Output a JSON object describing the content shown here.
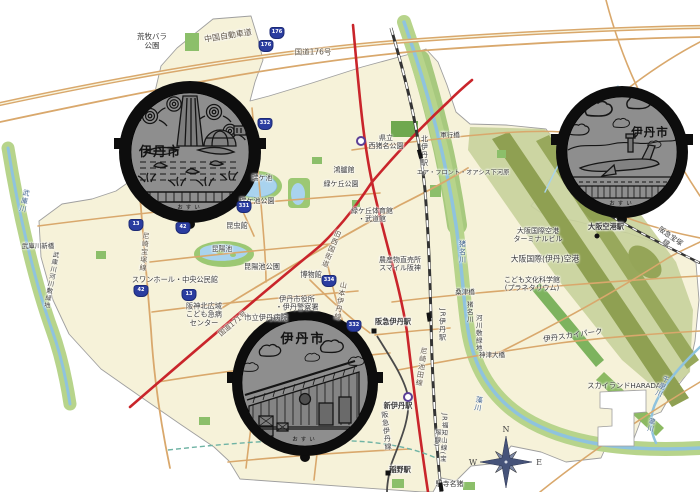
{
  "compass": {
    "n": "N",
    "w": "W",
    "e": "E",
    "s": "S"
  },
  "manholes": [
    {
      "design": "rose-pond-design",
      "city_label": "伊丹市",
      "bottom_label": "おすい"
    },
    {
      "design": "airport-design",
      "city_label": "伊丹市",
      "bottom_label": "おすい"
    },
    {
      "design": "brewery-design",
      "city_label": "伊丹市",
      "bottom_label": "おすい"
    }
  ],
  "route_shields": [
    {
      "n": "176",
      "x": 277,
      "y": 33
    },
    {
      "n": "176",
      "x": 266,
      "y": 46
    },
    {
      "n": "332",
      "x": 265,
      "y": 124
    },
    {
      "n": "331",
      "x": 244,
      "y": 207
    },
    {
      "n": "13",
      "x": 136,
      "y": 225
    },
    {
      "n": "42",
      "x": 183,
      "y": 228
    },
    {
      "n": "42",
      "x": 141,
      "y": 291
    },
    {
      "n": "13",
      "x": 189,
      "y": 295
    },
    {
      "n": "334",
      "x": 329,
      "y": 281
    },
    {
      "n": "332",
      "x": 354,
      "y": 326
    }
  ],
  "stations": [
    {
      "type": "rect",
      "x": 420,
      "y": 154,
      "rot": 75
    },
    {
      "type": "rect",
      "x": 429,
      "y": 317,
      "rot": 82
    },
    {
      "type": "square",
      "x": 374,
      "y": 331,
      "rot": 0
    },
    {
      "type": "circle",
      "x": 408,
      "y": 397,
      "rot": 0
    },
    {
      "type": "square",
      "x": 388,
      "y": 473,
      "rot": 0
    },
    {
      "type": "rect",
      "x": 441,
      "y": 487,
      "rot": 82
    },
    {
      "type": "dot",
      "x": 597,
      "y": 236,
      "rot": 0
    },
    {
      "type": "circle",
      "x": 361,
      "y": 141,
      "rot": 0
    }
  ],
  "map_labels": [
    {
      "t": "荒牧バラ\n公園",
      "x": 152,
      "y": 42,
      "s": 7.5
    },
    {
      "t": "中国自動車道",
      "x": 228,
      "y": 36,
      "s": 8,
      "r": -9,
      "c": "road"
    },
    {
      "t": "国道176号",
      "x": 313,
      "y": 53,
      "s": 7.5,
      "c": "road"
    },
    {
      "t": "県立\n西猪名公園",
      "x": 386,
      "y": 142,
      "s": 7
    },
    {
      "t": "北伊丹駅",
      "x": 424,
      "y": 151,
      "s": 7,
      "v": true
    },
    {
      "t": "軍行橋",
      "x": 450,
      "y": 136,
      "s": 6.5
    },
    {
      "t": "エア・フロント・オアシス下河原",
      "x": 463,
      "y": 173,
      "s": 6.2
    },
    {
      "t": "鴻臚館",
      "x": 344,
      "y": 170,
      "s": 7
    },
    {
      "t": "緑ケ丘公園",
      "x": 341,
      "y": 184,
      "s": 7
    },
    {
      "t": "瑞ケ池",
      "x": 262,
      "y": 178,
      "s": 6.8
    },
    {
      "t": "瑞ケ池公園",
      "x": 257,
      "y": 201,
      "s": 7
    },
    {
      "t": "緑ケ丘体育館\n・武道館",
      "x": 372,
      "y": 215,
      "s": 7
    },
    {
      "t": "昆虫館",
      "x": 237,
      "y": 226,
      "s": 7.2
    },
    {
      "t": "昆陽池",
      "x": 222,
      "y": 249,
      "s": 6.8
    },
    {
      "t": "昆陽池公園",
      "x": 262,
      "y": 267,
      "s": 7.2
    },
    {
      "t": "博物館",
      "x": 311,
      "y": 275,
      "s": 7.2
    },
    {
      "t": "スワンホール・中央公民館",
      "x": 175,
      "y": 280,
      "s": 7.2
    },
    {
      "t": "阪神北広域\nこども急病\nセンター",
      "x": 204,
      "y": 315,
      "s": 7.2
    },
    {
      "t": "伊丹市役所\n・伊丹警察署",
      "x": 297,
      "y": 304,
      "s": 7.2
    },
    {
      "t": "市立伊丹病院",
      "x": 266,
      "y": 318,
      "s": 7.2
    },
    {
      "t": "国道171号",
      "x": 233,
      "y": 324,
      "s": 7,
      "r": -40,
      "c": "road"
    },
    {
      "t": "旧西国街道",
      "x": 331,
      "y": 249,
      "s": 7,
      "v": true,
      "r": 22,
      "c": "road"
    },
    {
      "t": "山本伊丹線",
      "x": 340,
      "y": 301,
      "s": 7,
      "v": true,
      "r": 10,
      "c": "road"
    },
    {
      "t": "農産物直売所\nスマイル阪神",
      "x": 400,
      "y": 264,
      "s": 7
    },
    {
      "t": "阪急伊丹駅",
      "x": 393,
      "y": 322,
      "s": 7.2,
      "w": 600
    },
    {
      "t": "JR伊丹駅",
      "x": 442,
      "y": 325,
      "s": 7,
      "v": true
    },
    {
      "t": "尼崎池田線",
      "x": 421,
      "y": 367,
      "s": 7,
      "v": true,
      "r": 8,
      "c": "road"
    },
    {
      "t": "新伊丹駅",
      "x": 398,
      "y": 406,
      "s": 7.2,
      "w": 600
    },
    {
      "t": "阪急伊丹線",
      "x": 386,
      "y": 431,
      "s": 7,
      "v": true,
      "r": -6
    },
    {
      "t": "JR福知山線(宝塚線)",
      "x": 440,
      "y": 438,
      "s": 6.5,
      "v": true,
      "r": 3
    },
    {
      "t": "稲野駅",
      "x": 400,
      "y": 470,
      "s": 7.2,
      "w": 600
    },
    {
      "t": "猪名寺駅",
      "x": 449,
      "y": 484,
      "s": 7,
      "v": true
    },
    {
      "t": "猪名川",
      "x": 462,
      "y": 252,
      "s": 7,
      "v": true,
      "c": "river"
    },
    {
      "t": "猪名川",
      "x": 469,
      "y": 312,
      "s": 6.5,
      "v": true
    },
    {
      "t": "河川敷緑地",
      "x": 478,
      "y": 333,
      "s": 6.5,
      "v": true
    },
    {
      "t": "桑津橋",
      "x": 465,
      "y": 293,
      "s": 6.5
    },
    {
      "t": "神津大橋",
      "x": 492,
      "y": 356,
      "s": 6.5
    },
    {
      "t": "藻川",
      "x": 478,
      "y": 404,
      "s": 7,
      "v": true,
      "r": 10,
      "c": "river"
    },
    {
      "t": "大阪国際(伊丹)空港",
      "x": 545,
      "y": 259,
      "s": 7.8
    },
    {
      "t": "こども文化科学館\n(プラネタリウム)",
      "x": 532,
      "y": 284,
      "s": 7
    },
    {
      "t": "伊丹スカイパーク",
      "x": 573,
      "y": 336,
      "s": 7.5,
      "r": -8
    },
    {
      "t": "スカイランドHARADA",
      "x": 624,
      "y": 386,
      "s": 7.2
    },
    {
      "t": "千里川",
      "x": 661,
      "y": 386,
      "s": 6.8,
      "v": true,
      "r": 25,
      "c": "river"
    },
    {
      "t": "大阪国際空港\nターミナルビル",
      "x": 538,
      "y": 235,
      "s": 7
    },
    {
      "t": "大阪空港駅",
      "x": 606,
      "y": 227,
      "s": 7.2,
      "w": 600
    },
    {
      "t": "阪急宝塚線",
      "x": 668,
      "y": 240,
      "s": 7,
      "r": 35
    },
    {
      "t": "武庫川",
      "x": 24,
      "y": 201,
      "s": 7,
      "v": true,
      "r": 12,
      "c": "river"
    },
    {
      "t": "武庫川新橋",
      "x": 38,
      "y": 247,
      "s": 6.5
    },
    {
      "t": "武庫川河川敷緑地",
      "x": 50,
      "y": 280,
      "s": 6.3,
      "v": true,
      "r": 10
    },
    {
      "t": "尼崎宝塚線",
      "x": 144,
      "y": 252,
      "s": 7,
      "v": true,
      "r": 5,
      "c": "road"
    },
    {
      "t": "瀧川",
      "x": 650,
      "y": 425,
      "s": 6.5,
      "v": true,
      "r": 10,
      "c": "river"
    }
  ]
}
